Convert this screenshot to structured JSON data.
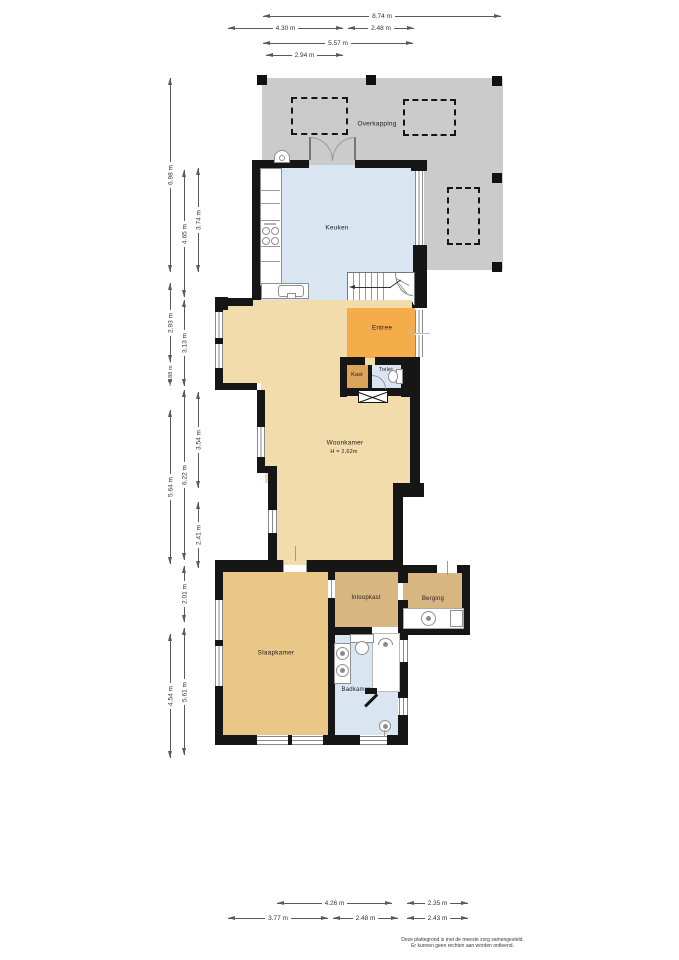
{
  "rooms": {
    "overkapping": "Overkapping",
    "keuken": "Keuken",
    "entree": "Entree",
    "kast": "Kast",
    "toilet": "Toilet",
    "woonkamer": "Woonkamer",
    "woonkamer_height": "H = 2,62m",
    "inloopkast": "Inloopkast",
    "berging": "Berging",
    "slaapkamer": "Slaapkamer",
    "badkamer": "Badkamer"
  },
  "dims": {
    "top": [
      "8.74 m",
      "4.30 m",
      "2.48 m",
      "5.57 m",
      "2.94 m"
    ],
    "left": [
      "6.98 m",
      "2.93 m",
      "0.88 m",
      "5.64 m",
      "4.54 m",
      "4.65 m",
      "3.13 m",
      "6.22 m",
      "2.01 m",
      "5.61 m",
      "3.74 m",
      "3.54 m",
      "2.41 m"
    ],
    "bottom": [
      "4.26 m",
      "2.35 m",
      "3.77 m",
      "2.48 m",
      "2.43 m"
    ]
  },
  "disclaimer": {
    "line1": "Deze plattegrond is met de meeste zorg samengesteld.",
    "line2": "Er kunnen geen rechten aan worden ontleend."
  },
  "colors": {
    "wall": "#161616",
    "overkapping": "#cbcbcb",
    "keuken": "#d9e6f2",
    "toilet": "#d9e6f2",
    "badkamer": "#d9e6f2",
    "entree": "#f5ac4b",
    "kast": "#dba35c",
    "woonkamer": "#f2dcab",
    "slaapkamer": "#e9c787",
    "inloopkast": "#d8b681",
    "berging": "#d8b681"
  }
}
